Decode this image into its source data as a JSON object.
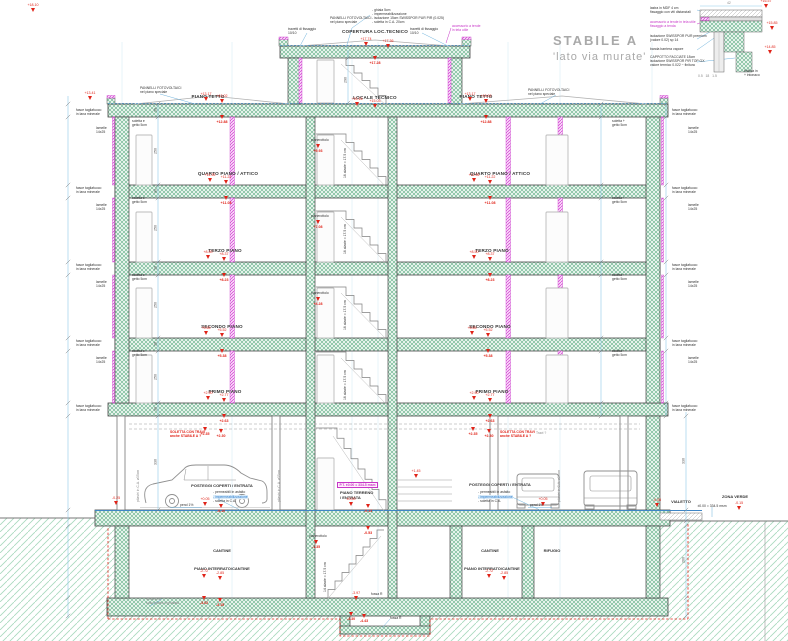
{
  "title": {
    "line1": "STABILE A",
    "line2": "'lato via murate'"
  },
  "colors": {
    "hatch_green": "#5fae85",
    "ground_green": "#a8d9be",
    "column_magenta": "#c836c8",
    "marker_red": "#e02318",
    "dimension_blue": "#8ec9e8",
    "title_gray": "#a9a9a9"
  },
  "labels": [
    {
      "n": "label-copertura",
      "t": "COPERTURA LOC.TECNICO",
      "x": 375,
      "y": 29,
      "c": "f ctr"
    },
    {
      "n": "label-locale-tecnico",
      "t": "LOCALE TECNICO",
      "x": 375,
      "y": 95,
      "c": "f ctr"
    },
    {
      "n": "label-piano-tetto-left",
      "t": "PIANO TETTO",
      "x": 208,
      "y": 94,
      "c": "f ctr"
    },
    {
      "n": "label-piano-tetto-right",
      "t": "PIANO TETTO",
      "x": 476,
      "y": 94,
      "c": "f ctr"
    },
    {
      "n": "label-quarto-left",
      "t": "QUARTO PIANO / ATTICO",
      "x": 228,
      "y": 171,
      "c": "f ctr"
    },
    {
      "n": "label-quarto-right",
      "t": "QUARTO PIANO / ATTICO",
      "x": 500,
      "y": 171,
      "c": "f ctr"
    },
    {
      "n": "label-terzo-left",
      "t": "TERZO PIANO",
      "x": 225,
      "y": 248,
      "c": "f ctr"
    },
    {
      "n": "label-terzo-right",
      "t": "TERZO PIANO",
      "x": 492,
      "y": 248,
      "c": "f ctr"
    },
    {
      "n": "label-secondo-left",
      "t": "SECONDO PIANO",
      "x": 222,
      "y": 324,
      "c": "f ctr"
    },
    {
      "n": "label-secondo-right",
      "t": "SECONDO PIANO",
      "x": 490,
      "y": 324,
      "c": "f ctr"
    },
    {
      "n": "label-primo-left",
      "t": "PRIMO PIANO",
      "x": 225,
      "y": 389,
      "c": "f ctr"
    },
    {
      "n": "label-primo-right",
      "t": "PRIMO PIANO",
      "x": 492,
      "y": 389,
      "c": "f ctr"
    },
    {
      "n": "label-piano-terreno",
      "t": "PIANO TERRENO\n/ ENTRATA",
      "x": 340,
      "y": 491,
      "c": "t4"
    },
    {
      "n": "label-pt-quota",
      "t": "P.T. ±0.00 = 334.5 msm",
      "x": 337,
      "y": 482,
      "c": "t box"
    },
    {
      "n": "label-cantine-left",
      "t": "CANTINE",
      "x": 222,
      "y": 549,
      "c": "t4 ctr"
    },
    {
      "n": "label-cantine-right",
      "t": "CANTINE",
      "x": 490,
      "y": 549,
      "c": "t4 ctr"
    },
    {
      "n": "label-rifugio",
      "t": "RIFUGIO",
      "x": 552,
      "y": 549,
      "c": "t4 ctr"
    },
    {
      "n": "label-interrato-left",
      "t": "PIANO INTERRATO/CANTINE",
      "x": 222,
      "y": 567,
      "c": "t4 ctr"
    },
    {
      "n": "label-interrato-right",
      "t": "PIANO INTERRATO/CANTINE",
      "x": 492,
      "y": 567,
      "c": "t4 ctr"
    },
    {
      "n": "label-vialetto",
      "t": "VIALETTO",
      "x": 681,
      "y": 500,
      "c": "t4 ctr"
    },
    {
      "n": "label-zona-verde",
      "t": "ZONA VERDE",
      "x": 735,
      "y": 495,
      "c": "t4 ctr"
    },
    {
      "n": "label-zona-verde-quota",
      "t": "±0.00 = 334.5 msm",
      "x": 712,
      "y": 504,
      "c": "t ctr"
    },
    {
      "n": "label-posteggi-left",
      "t": "POSTEGGI COPERTI / ENTRATA",
      "x": 222,
      "y": 484,
      "c": "t4 ctr"
    },
    {
      "n": "label-posteggi-right",
      "t": "POSTEGGI COPERTI / ENTRATA",
      "x": 500,
      "y": 483,
      "c": "t4 ctr"
    },
    {
      "n": "label-soletta-travi-left",
      "t": "SOLETTA CON TRAVI\nanche STABILE A ?",
      "x": 170,
      "y": 430,
      "c": "t red b"
    },
    {
      "n": "label-soletta-travi-right",
      "t": "SOLETTA CON TRAVI\nanche STABILE A ?",
      "x": 500,
      "y": 430,
      "c": "t red b"
    },
    {
      "n": "label-travi-q",
      "t": "Travi ?",
      "x": 536,
      "y": 431,
      "c": "t gry"
    },
    {
      "n": "label-buildup-garage-left-1",
      "t": "- permeabili in asfalto",
      "x": 213,
      "y": 490,
      "c": "t"
    },
    {
      "n": "label-buildup-garage-left-2",
      "t": "- impermeabilizzazione",
      "x": 213,
      "y": 494.5,
      "c": "t blu hl"
    },
    {
      "n": "label-buildup-garage-left-3",
      "t": "- soletta in C.A.",
      "x": 213,
      "y": 499,
      "c": "t"
    },
    {
      "n": "label-buildup-garage-right-1",
      "t": "- permeabili in asfalto",
      "x": 478,
      "y": 490,
      "c": "t"
    },
    {
      "n": "label-buildup-garage-right-2",
      "t": "- impermeabilizzazione",
      "x": 478,
      "y": 494.5,
      "c": "t blu hl"
    },
    {
      "n": "label-buildup-garage-right-3",
      "t": "- soletta in C.A.",
      "x": 478,
      "y": 499,
      "c": "t"
    },
    {
      "n": "label-pend-left",
      "t": "pend 1%",
      "x": 180,
      "y": 503,
      "c": "t"
    },
    {
      "n": "label-pend-right",
      "t": "pend 1%",
      "x": 530,
      "y": 503,
      "c": "t"
    },
    {
      "n": "label-roof-buildup",
      "t": "- ghiaia 5cm\n- impermeabilizzazione\n- isolazione 15cm SWISSPOR PUR PIR (0.025)\n- soletta in C.A. 20cm",
      "x": 372,
      "y": 8,
      "c": "t"
    },
    {
      "n": "label-pannelli-top",
      "t": "PANNELLI FOTOVOLTAICI\nnel piano speciale",
      "x": 330,
      "y": 16,
      "c": "t"
    },
    {
      "n": "label-pannelli-left",
      "t": "PANNELLI FOTOVOLTAICI\nnel piano speciale",
      "x": 140,
      "y": 86,
      "c": "t"
    },
    {
      "n": "label-pannelli-right",
      "t": "PANNELLI FOTOVOLTAICI\nnel piano speciale",
      "x": 528,
      "y": 88,
      "c": "t"
    },
    {
      "n": "label-travetti-left",
      "t": "travetti di fissaggio\n10/10",
      "x": 288,
      "y": 27,
      "c": "t"
    },
    {
      "n": "label-travetti-right",
      "t": "travetti di fissaggio\n10/10",
      "x": 410,
      "y": 27,
      "c": "t"
    },
    {
      "n": "label-accessorio-top",
      "t": "accessorio a tende\nin tela utile",
      "x": 452,
      "y": 24,
      "c": "t mag"
    },
    {
      "n": "label-fasce-left-1",
      "t": "fasce tagliafuoco\nin lana minerale",
      "x": 76,
      "y": 108,
      "c": "t"
    },
    {
      "n": "label-fasce-left-2",
      "t": "fasce tagliafuoco\nin lana minerale",
      "x": 76,
      "y": 186,
      "c": "t"
    },
    {
      "n": "label-fasce-left-3",
      "t": "fasce tagliafuoco\nin lana minerale",
      "x": 76,
      "y": 263,
      "c": "t"
    },
    {
      "n": "label-fasce-left-4",
      "t": "fasce tagliafuoco\nin lana minerale",
      "x": 76,
      "y": 339,
      "c": "t"
    },
    {
      "n": "label-fasce-left-5",
      "t": "fasce tagliafuoco\nin lana minerale",
      "x": 76,
      "y": 404,
      "c": "t"
    },
    {
      "n": "label-fasce-right-1",
      "t": "fasce tagliafuoco\nin lana minerale",
      "x": 672,
      "y": 108,
      "c": "t"
    },
    {
      "n": "label-fasce-right-2",
      "t": "fasce tagliafuoco\nin lana minerale",
      "x": 672,
      "y": 186,
      "c": "t"
    },
    {
      "n": "label-fasce-right-3",
      "t": "fasce tagliafuoco\nin lana minerale",
      "x": 672,
      "y": 263,
      "c": "t"
    },
    {
      "n": "label-fasce-right-4",
      "t": "fasce tagliafuoco\nin lana minerale",
      "x": 672,
      "y": 339,
      "c": "t"
    },
    {
      "n": "label-fasce-right-5",
      "t": "fasce tagliafuoco\nin lana minerale",
      "x": 672,
      "y": 404,
      "c": "t"
    },
    {
      "n": "label-lamelle-left-1",
      "t": "lamelle\n14x25",
      "x": 96,
      "y": 126,
      "c": "t"
    },
    {
      "n": "label-lamelle-left-2",
      "t": "lamelle\n14x25",
      "x": 96,
      "y": 203,
      "c": "t"
    },
    {
      "n": "label-lamelle-left-3",
      "t": "lamelle\n14x25",
      "x": 96,
      "y": 280,
      "c": "t"
    },
    {
      "n": "label-lamelle-left-4",
      "t": "lamelle\n14x25",
      "x": 96,
      "y": 356,
      "c": "t"
    },
    {
      "n": "label-lamelle-right-1",
      "t": "lamelle\n14x25",
      "x": 688,
      "y": 126,
      "c": "t"
    },
    {
      "n": "label-lamelle-right-2",
      "t": "lamelle\n14x25",
      "x": 688,
      "y": 203,
      "c": "t"
    },
    {
      "n": "label-lamelle-right-3",
      "t": "lamelle\n14x25",
      "x": 688,
      "y": 280,
      "c": "t"
    },
    {
      "n": "label-lamelle-right-4",
      "t": "lamelle\n14x25",
      "x": 688,
      "y": 356,
      "c": "t"
    },
    {
      "n": "label-soletta-getto-left-1",
      "t": "soletta e\ngetto 5cm",
      "x": 132,
      "y": 119,
      "c": "t"
    },
    {
      "n": "label-soletta-getto-left-2",
      "t": "soletta e\ngetto 5cm",
      "x": 132,
      "y": 196,
      "c": "t"
    },
    {
      "n": "label-soletta-getto-left-3",
      "t": "soletta e\ngetto 5cm",
      "x": 132,
      "y": 273,
      "c": "t"
    },
    {
      "n": "label-soletta-getto-left-4",
      "t": "soletta e\ngetto 5cm",
      "x": 132,
      "y": 349,
      "c": "t"
    },
    {
      "n": "label-soletta-getto-right-1",
      "t": "soletta +\ngetto 5cm",
      "x": 612,
      "y": 119,
      "c": "t"
    },
    {
      "n": "label-soletta-getto-right-2",
      "t": "soletta +\ngetto 5cm",
      "x": 612,
      "y": 196,
      "c": "t"
    },
    {
      "n": "label-soletta-getto-right-3",
      "t": "soletta +\ngetto 5cm",
      "x": 612,
      "y": 273,
      "c": "t"
    },
    {
      "n": "label-soletta-getto-right-4",
      "t": "soletta +\ngetto 5cm",
      "x": 612,
      "y": 349,
      "c": "t"
    },
    {
      "n": "label-pianerottolo-1",
      "t": "pianerottolo",
      "x": 311,
      "y": 138,
      "c": "t"
    },
    {
      "n": "label-pianerottolo-2",
      "t": "pianerottolo",
      "x": 311,
      "y": 214,
      "c": "t"
    },
    {
      "n": "label-pianerottolo-3",
      "t": "pianerottolo",
      "x": 311,
      "y": 291,
      "c": "t"
    },
    {
      "n": "label-pianerottolo-int",
      "t": "pianerottolo",
      "x": 309,
      "y": 534,
      "c": "t"
    },
    {
      "n": "label-alzate-1",
      "t": "16 alzate = 17.5 cm",
      "x": 343,
      "y": 178,
      "c": "t rot"
    },
    {
      "n": "label-alzate-2",
      "t": "16 alzate = 17.5 cm",
      "x": 343,
      "y": 254,
      "c": "t rot"
    },
    {
      "n": "label-alzate-3",
      "t": "16 alzate = 17.5 cm",
      "x": 343,
      "y": 330,
      "c": "t rot"
    },
    {
      "n": "label-alzate-4",
      "t": "16 alzate = 17.5 cm",
      "x": 343,
      "y": 400,
      "c": "t rot"
    },
    {
      "n": "label-alzate-int",
      "t": "14 alzate = 17.5 cm",
      "x": 323,
      "y": 592,
      "c": "t rot"
    },
    {
      "n": "label-pilastri-1",
      "t": "pilastri in C.A. ø35cm",
      "x": 136,
      "y": 502,
      "c": "t gry rot"
    },
    {
      "n": "label-pilastri-2",
      "t": "pilastri in C.A. ø35cm",
      "x": 277,
      "y": 502,
      "c": "t gry rot"
    },
    {
      "n": "label-pilastri-3",
      "t": "pilastri in C.A. ø35cm",
      "x": 557,
      "y": 502,
      "c": "t gry rot"
    },
    {
      "n": "label-fossa-1",
      "t": "fossa R",
      "x": 371,
      "y": 592,
      "c": "t"
    },
    {
      "n": "label-fossa-2",
      "t": "fossa R",
      "x": 390,
      "y": 616,
      "c": "t"
    },
    {
      "n": "label-platea-note",
      "t": "isolazione\nsotto platea inghiaiata",
      "x": 146,
      "y": 597,
      "c": "t gry"
    },
    {
      "n": "label-detail-mdf",
      "t": "lastra in MDF 4 cm\nfissaggio con viti distanziali",
      "x": 650,
      "y": 6,
      "c": "t"
    },
    {
      "n": "label-detail-accessorio",
      "t": "accessorio a tende in tela utile\nfissaggio a tenda",
      "x": 650,
      "y": 20,
      "c": "t mag"
    },
    {
      "n": "label-detail-isolazione",
      "t": "isolazione SWISSPOR PUR premium\n(valore 0.02) sp 14",
      "x": 650,
      "y": 34,
      "c": "t"
    },
    {
      "n": "label-detail-vapore",
      "t": "banda barriera vapore",
      "x": 650,
      "y": 47,
      "c": "t"
    },
    {
      "n": "label-detail-cappotto",
      "t": "CAPPOTTO FACCIATE 18cm\nisolazione SWISSPOR PIR TOP GX\nvalore termico 0.022 ~ finitura",
      "x": 650,
      "y": 55,
      "c": "t"
    },
    {
      "n": "label-detail-finitura",
      "t": "finitura in\n+ intonaco",
      "x": 744,
      "y": 69,
      "c": "t"
    },
    {
      "n": "label-detail-dim-bottom",
      "t": "0.5   18   1.5",
      "x": 698,
      "y": 74,
      "c": "t gry"
    },
    {
      "n": "label-detail-dim-top",
      "t": "42",
      "x": 727,
      "y": 1,
      "c": "t gry"
    }
  ],
  "elevation_markers": [
    [
      366,
      46,
      "+17.74",
      "a"
    ],
    [
      388,
      48,
      "+17.36",
      "a"
    ],
    [
      375,
      60,
      "+17.28",
      "b"
    ],
    [
      357,
      106,
      "+15.16",
      "a"
    ],
    [
      375,
      108,
      "+15.03",
      "a"
    ],
    [
      206,
      101,
      "+13.17",
      "a"
    ],
    [
      222,
      103,
      "+13.02",
      "a"
    ],
    [
      222,
      119,
      "+12.88",
      "b"
    ],
    [
      470,
      101,
      "+13.17",
      "a"
    ],
    [
      486,
      103,
      "+13.02",
      "a"
    ],
    [
      486,
      119,
      "+12.88",
      "b"
    ],
    [
      90,
      100,
      "+13.41",
      "a"
    ],
    [
      33,
      12,
      "+18.10",
      "a"
    ],
    [
      210,
      182,
      "+11.35",
      "a"
    ],
    [
      226,
      184,
      "+11.22",
      "a"
    ],
    [
      226,
      200,
      "+11.08",
      "b"
    ],
    [
      474,
      182,
      "+11.35",
      "a"
    ],
    [
      490,
      184,
      "+11.22",
      "a"
    ],
    [
      490,
      200,
      "+11.08",
      "b"
    ],
    [
      208,
      259,
      "+8.50",
      "a"
    ],
    [
      224,
      261,
      "+8.37",
      "a"
    ],
    [
      224,
      277,
      "+8.23",
      "b"
    ],
    [
      474,
      259,
      "+8.50",
      "a"
    ],
    [
      490,
      261,
      "+8.37",
      "a"
    ],
    [
      490,
      277,
      "+8.23",
      "b"
    ],
    [
      206,
      335,
      "+5.65",
      "a"
    ],
    [
      222,
      337,
      "+5.52",
      "a"
    ],
    [
      222,
      353,
      "+5.38",
      "b"
    ],
    [
      472,
      335,
      "+5.65",
      "a"
    ],
    [
      488,
      337,
      "+5.52",
      "a"
    ],
    [
      488,
      353,
      "+5.38",
      "b"
    ],
    [
      208,
      400,
      "+2.90",
      "a"
    ],
    [
      224,
      402,
      "+2.77",
      "a"
    ],
    [
      224,
      418,
      "+2.63",
      "b"
    ],
    [
      474,
      400,
      "+2.90",
      "a"
    ],
    [
      490,
      402,
      "+2.77",
      "a"
    ],
    [
      490,
      418,
      "+2.63",
      "b"
    ],
    [
      205,
      431,
      "+2.35",
      "b"
    ],
    [
      221,
      433,
      "+2.30",
      "b"
    ],
    [
      473,
      431,
      "+2.35",
      "b"
    ],
    [
      489,
      433,
      "+2.30",
      "b"
    ],
    [
      205,
      506,
      "+0.05",
      "a"
    ],
    [
      221,
      508,
      "-0.10",
      "b"
    ],
    [
      116,
      505,
      "-0.25",
      "a"
    ],
    [
      543,
      506,
      "+0.05",
      "a"
    ],
    [
      657,
      507,
      "-0.05",
      "a"
    ],
    [
      351,
      506,
      "±0.00",
      "a"
    ],
    [
      368,
      508,
      "-0.13",
      "b"
    ],
    [
      368,
      530,
      "-0.53",
      "b"
    ],
    [
      318,
      148,
      "+9.93",
      "b"
    ],
    [
      318,
      224,
      "+7.08",
      "b"
    ],
    [
      318,
      301,
      "+4.28",
      "b"
    ],
    [
      316,
      544,
      "-1.35",
      "b"
    ],
    [
      416,
      478,
      "+1.45",
      "a"
    ],
    [
      739,
      510,
      "-0.15",
      "a"
    ],
    [
      204,
      578,
      "-2.72",
      "a"
    ],
    [
      220,
      580,
      "-2.85",
      "a"
    ],
    [
      204,
      600,
      "-3.02",
      "b"
    ],
    [
      220,
      602,
      "-3.15",
      "b"
    ],
    [
      489,
      578,
      "-2.72",
      "a"
    ],
    [
      504,
      580,
      "-2.85",
      "a"
    ],
    [
      356,
      600,
      "-3.97",
      "a"
    ],
    [
      351,
      616,
      "-4.30",
      "b"
    ],
    [
      364,
      618,
      "-4.43",
      "b"
    ],
    [
      766,
      8,
      "+16.57",
      "a"
    ],
    [
      772,
      30,
      "+15.85",
      "a"
    ],
    [
      770,
      54,
      "+14.85",
      "a"
    ]
  ],
  "dimension_chains": [
    {
      "x": 68,
      "y1": 96,
      "y2": 618,
      "ticks": [
        104,
        117,
        185,
        198,
        262,
        275,
        338,
        351,
        403,
        416,
        510,
        526,
        598,
        616
      ],
      "nums": []
    },
    {
      "x": 158,
      "y1": 104,
      "y2": 510,
      "ticks": [
        104,
        117,
        185,
        198,
        262,
        275,
        338,
        351,
        403,
        416,
        510
      ],
      "nums": [
        [
          "30",
          110
        ],
        [
          "250",
          151
        ],
        [
          "30",
          191
        ],
        [
          "250",
          228
        ],
        [
          "30",
          268
        ],
        [
          "250",
          305
        ],
        [
          "30",
          344
        ],
        [
          "250",
          377
        ],
        [
          "30",
          409
        ],
        [
          "330",
          462
        ]
      ]
    },
    {
      "x": 601,
      "y1": 104,
      "y2": 416,
      "ticks": [
        104,
        117,
        185,
        198,
        262,
        275,
        338,
        351,
        403,
        416
      ],
      "nums": []
    },
    {
      "x": 666,
      "y1": 104,
      "y2": 416,
      "ticks": [
        104,
        117,
        185,
        198,
        262,
        275,
        338,
        351,
        403,
        416
      ],
      "nums": []
    },
    {
      "x": 686,
      "y1": 412,
      "y2": 618,
      "ticks": [
        416,
        510,
        521,
        526,
        598,
        616
      ],
      "nums": [
        [
          "330",
          461
        ],
        [
          "260",
          560
        ]
      ]
    },
    {
      "x": 348,
      "y1": 50,
      "y2": 104,
      "ticks": [
        58,
        103
      ],
      "nums": [
        [
          "290",
          80
        ]
      ]
    }
  ]
}
